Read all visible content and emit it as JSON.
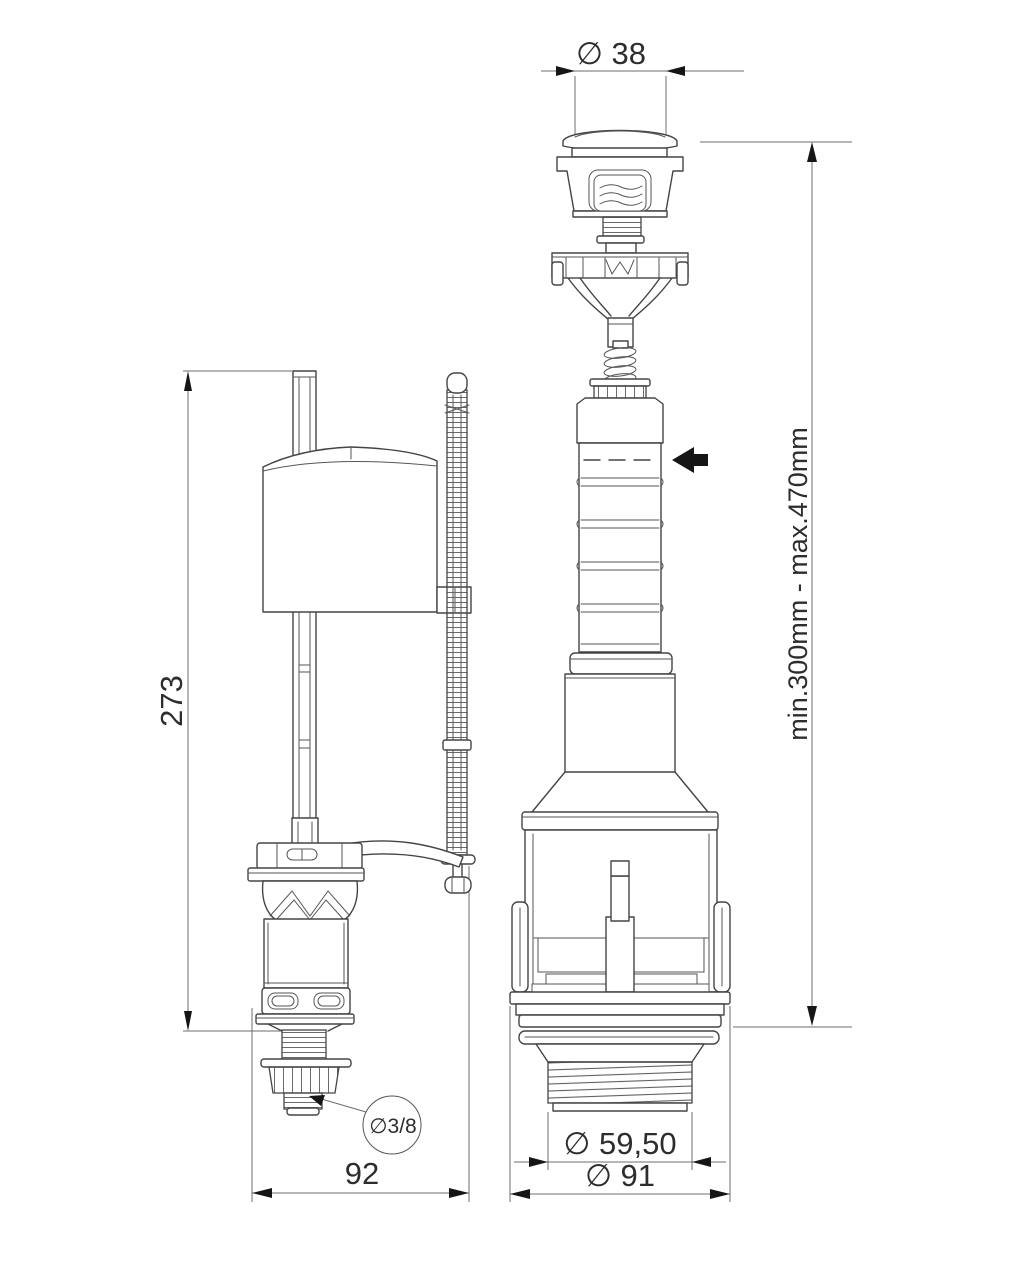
{
  "drawing": {
    "fill_valve": {
      "height_dim": "273",
      "width_dim": "92",
      "inlet_callout": "∅3/8"
    },
    "flush_valve": {
      "button_dim": "∅ 38",
      "thread_dim": "∅ 59,50",
      "base_dim": "∅ 91",
      "height_range_dim": "min.300mm - max.470mm"
    }
  }
}
